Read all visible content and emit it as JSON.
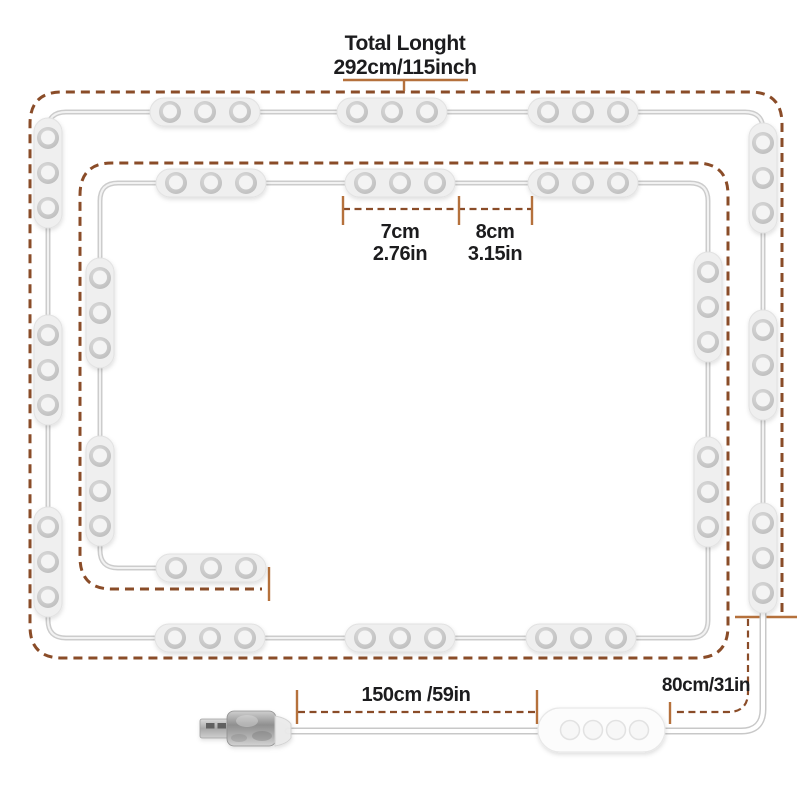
{
  "colors": {
    "dash": "#8a4c28",
    "tick": "#b5713c",
    "text": "#1c1c1e",
    "wire-outer": "#cccccc",
    "wire-inner": "#f2f2f2",
    "cable-outer": "#c8c8c8",
    "cable-inner": "#ffffff",
    "module-body": "#efefef",
    "module-edge": "#e2e2e2",
    "led-ring": "#c6c6c6",
    "led-face": "#f4f4f4",
    "controller-body": "#fcfcfc",
    "controller-edge": "#e8e8e8"
  },
  "total_length": {
    "title": "Total Longht",
    "value": "292cm/115inch"
  },
  "module_spacing": {
    "module_cm": "7cm",
    "module_in": "2.76in",
    "gap_cm": "8cm",
    "gap_in": "3.15in"
  },
  "usb_cable_length": {
    "value": "150cm /59in"
  },
  "controller_cable_length": {
    "value": "80cm/31in"
  },
  "hardware": {
    "led_module_count": 20,
    "leds_per_module": 3,
    "controller_button_count": 4,
    "plug_type": "usb-a-plug",
    "controller_type": "inline-button-controller"
  }
}
